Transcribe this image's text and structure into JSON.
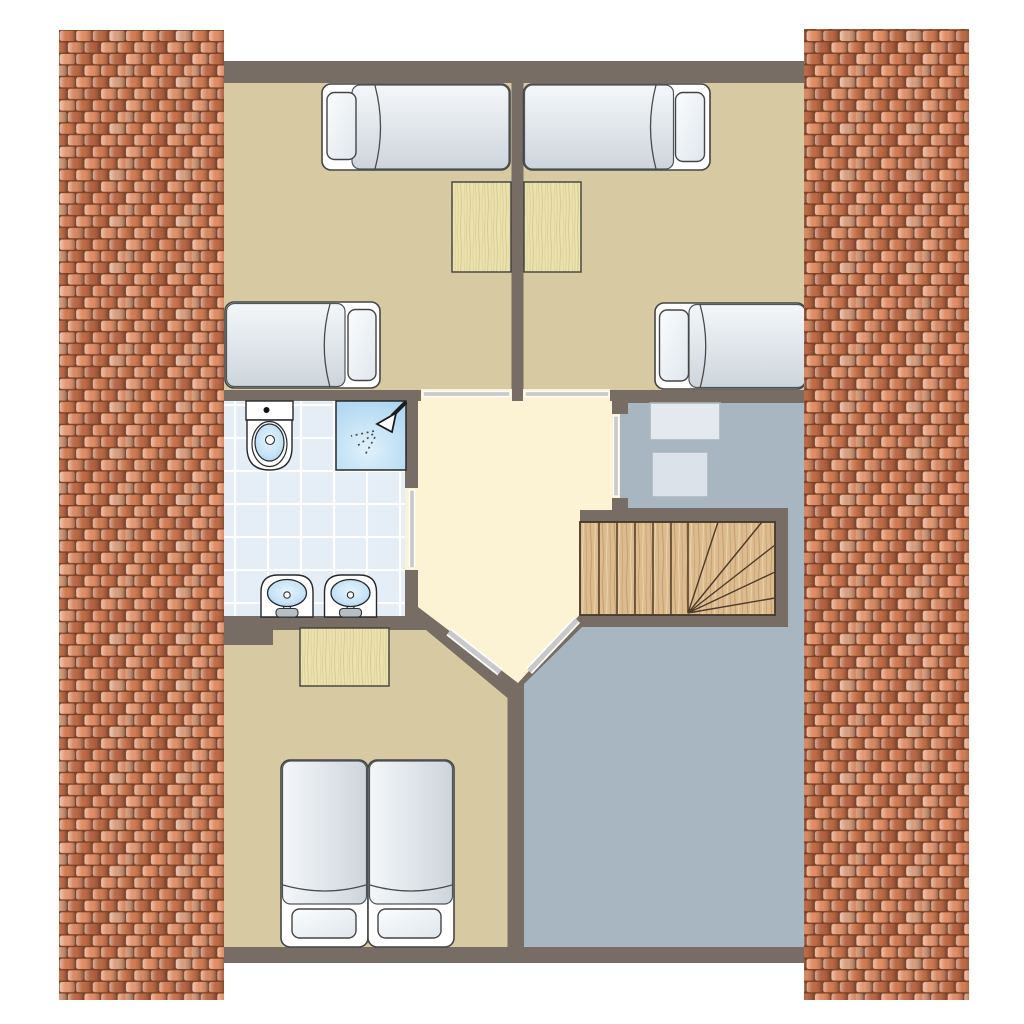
{
  "canvas": {
    "width": 1024,
    "height": 1024
  },
  "document": {
    "kind": "architectural-floor-plan",
    "text_labels": []
  },
  "palette": {
    "background": "#ffffff",
    "wall": "#776d65",
    "bedroom_floor": "#d7c9a1",
    "hallway_floor": "#fcf3d5",
    "attic_floor": "#a8b6c2",
    "bathroom_tile_base": "#e5edf6",
    "tile_grid_line": "#ffffff",
    "door_leaf": "#c9c9c9",
    "furniture_outline": "#454545",
    "sanitary_outline": "#26282b",
    "bed_white": "#ffffff",
    "mattress_light": "#f4f7f9",
    "mattress_dark": "#cdd5dc",
    "basin_blue_light": "#e8f5fd",
    "basin_blue_dark": "#9cc9e8",
    "shower_blue": "#a2d0ed",
    "desk_wood": "#ece2b0",
    "desk_wood_streak": "#d9cd92",
    "stairs_wood": "#dcbc8f",
    "stairs_wood_line": "#4e3b29",
    "storage_box": "#e0e6ec",
    "storage_box_border": "#aab6c0",
    "faucet_gray": "#b7bec4",
    "roof_gap": "#7c4328",
    "roof_tile_shades": [
      "#d27c54",
      "#e28e66",
      "#bc6a46",
      "#d99f80",
      "#c4714b",
      "#d88a64",
      "#b56342",
      "#e59a76"
    ]
  },
  "rooms": [
    {
      "id": "bedroom-top-left",
      "floor": "bedroom_floor",
      "furniture": [
        "single-bed",
        "single-bed",
        "desk"
      ]
    },
    {
      "id": "bedroom-top-right",
      "floor": "bedroom_floor",
      "furniture": [
        "single-bed",
        "single-bed",
        "desk"
      ]
    },
    {
      "id": "bathroom",
      "floor": "bathroom_tile_base",
      "furniture": [
        "toilet",
        "shower",
        "washbasin",
        "washbasin"
      ]
    },
    {
      "id": "landing-hallway",
      "floor": "hallway_floor",
      "furniture": []
    },
    {
      "id": "attic-storage",
      "floor": "attic_floor",
      "furniture": [
        "storage-box",
        "storage-box"
      ]
    },
    {
      "id": "bedroom-bottom",
      "floor": "bedroom_floor",
      "furniture": [
        "double-bed",
        "desk"
      ]
    },
    {
      "id": "staircase",
      "floor": "stairs_wood",
      "furniture": []
    }
  ],
  "doors": [
    {
      "between": [
        "landing-hallway",
        "bedroom-top-left"
      ]
    },
    {
      "between": [
        "landing-hallway",
        "bedroom-top-right"
      ]
    },
    {
      "between": [
        "landing-hallway",
        "bathroom"
      ]
    },
    {
      "between": [
        "landing-hallway",
        "attic-storage"
      ]
    },
    {
      "between": [
        "landing-hallway",
        "bedroom-bottom"
      ]
    },
    {
      "between": [
        "landing-hallway",
        "attic-storage"
      ]
    }
  ],
  "stairs": {
    "straight_tread_lines": 6,
    "winder_lines": 5
  },
  "roof": {
    "left_strip": true,
    "right_strip": true
  }
}
